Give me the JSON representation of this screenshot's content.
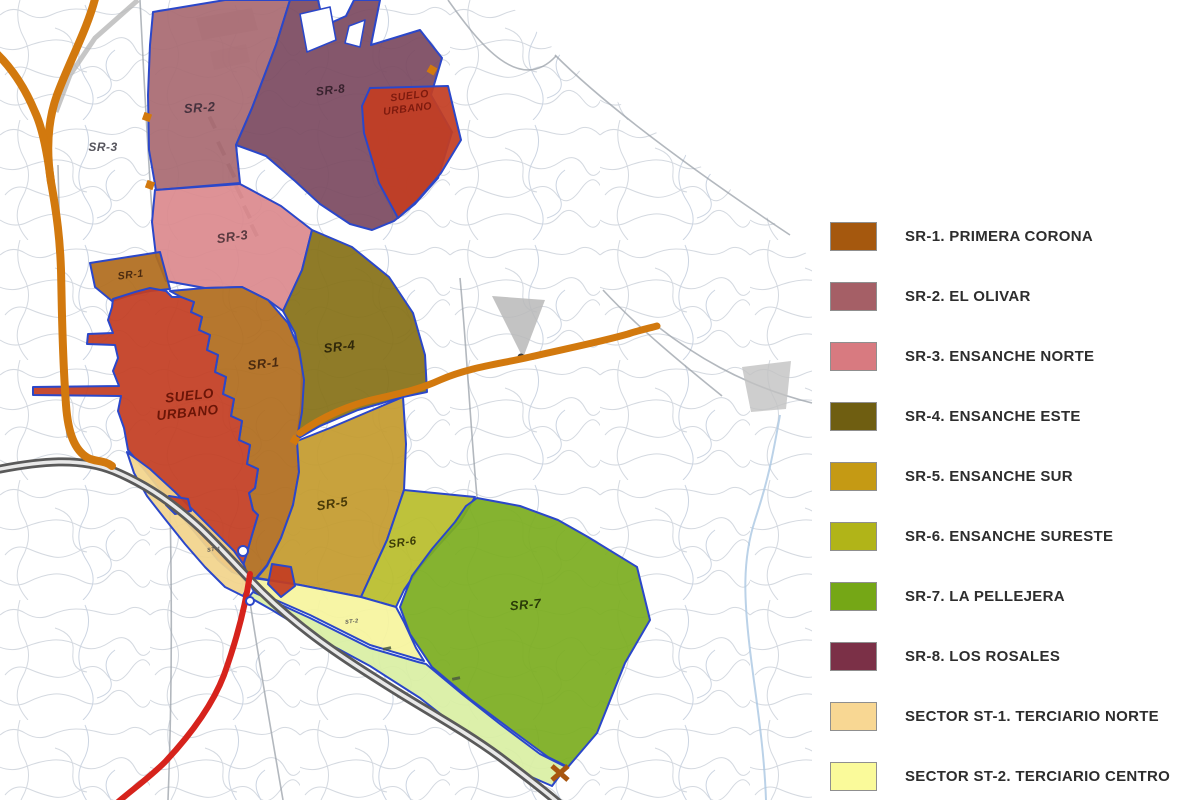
{
  "title": "Plan urbanistico - sectores de suelo",
  "legend": {
    "items": [
      {
        "id": "sr1",
        "label": "SR-1. PRIMERA CORONA",
        "color": "#a5580e"
      },
      {
        "id": "sr2",
        "label": "SR-2. EL OLIVAR",
        "color": "#a55f66"
      },
      {
        "id": "sr3",
        "label": "SR-3. ENSANCHE NORTE",
        "color": "#d87a80"
      },
      {
        "id": "sr4",
        "label": "SR-4. ENSANCHE ESTE",
        "color": "#6f5e11"
      },
      {
        "id": "sr5",
        "label": "SR-5. ENSANCHE SUR",
        "color": "#c59a14"
      },
      {
        "id": "sr6",
        "label": "SR-6. ENSANCHE SURESTE",
        "color": "#b1b418"
      },
      {
        "id": "sr7",
        "label": "SR-7. LA PELLEJERA",
        "color": "#75a716"
      },
      {
        "id": "sr8",
        "label": "SR-8. LOS ROSALES",
        "color": "#7b3047"
      },
      {
        "id": "st1",
        "label": "SECTOR ST-1. TERCIARIO NORTE",
        "color": "#f8d793"
      },
      {
        "id": "st2",
        "label": "SECTOR ST-2. TERCIARIO CENTRO",
        "color": "#fafa9a"
      }
    ]
  },
  "map": {
    "zones": {
      "sr2": {
        "name": "SR-2",
        "color": "#a96b72"
      },
      "sr8": {
        "name": "SR-8",
        "color": "#7c4a61"
      },
      "suelo_urbano_norte": {
        "name": "SUELO URBANO",
        "color": "#c33d22"
      },
      "sr3": {
        "name": "SR-3",
        "color": "#dc8a8e"
      },
      "sr4": {
        "name": "SR-4",
        "color": "#867118"
      },
      "sr1": {
        "name": "SR-1",
        "color": "#b06d1e"
      },
      "suelo_urbano": {
        "name": "SUELO URBANO",
        "color": "#c33d22"
      },
      "sr5": {
        "name": "SR-5",
        "color": "#c49b2e"
      },
      "sr6": {
        "name": "SR-6",
        "color": "#b9bd2c"
      },
      "sr7": {
        "name": "SR-7",
        "color": "#7cad20"
      },
      "st1": {
        "name": "ST-1",
        "color": "#f2d48c"
      },
      "st2": {
        "name": "ST-2",
        "color": "#f6f49e"
      },
      "st3_strip": {
        "name": "",
        "color": "#d9efa4"
      }
    },
    "road_colors": {
      "motorway_casing": "#5a5a5a",
      "motorway_core": "#e9e9e9",
      "national_orange": "#d2790e",
      "red_route": "#d6231c",
      "minor": "#9aa0a8",
      "rail": "#b8b8b8",
      "stream": "#aac7e2",
      "zone_border": "#2b47c9",
      "marker_orange": "#d2790e"
    },
    "labels": [
      {
        "text": "SR-2"
      },
      {
        "text": "SR-8"
      },
      {
        "text": "SUELO"
      },
      {
        "text": "URBANO"
      },
      {
        "text": "SR-3"
      },
      {
        "text": "SR-3"
      },
      {
        "text": "SR-1"
      },
      {
        "text": "SR-1"
      },
      {
        "text": "SR-4"
      },
      {
        "text": "SUELO"
      },
      {
        "text": "URBANO"
      },
      {
        "text": "SR-5"
      },
      {
        "text": "SR-6"
      },
      {
        "text": "SR-7"
      },
      {
        "text": "ST-1"
      },
      {
        "text": "ST-2"
      }
    ]
  }
}
